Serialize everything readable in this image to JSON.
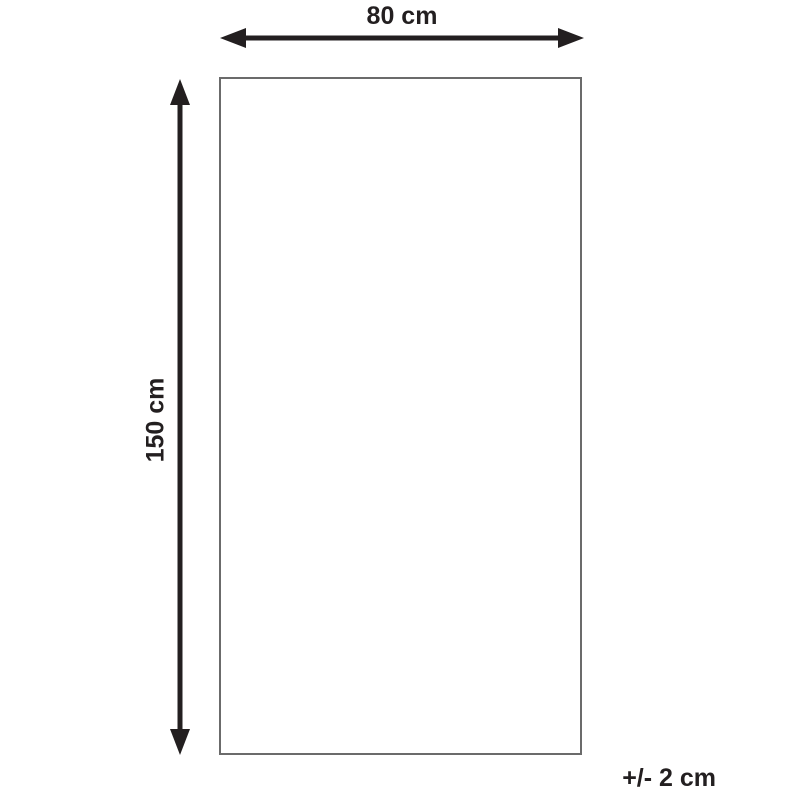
{
  "diagram": {
    "type": "product-dimension-diagram",
    "width_label": "80 cm",
    "height_label": "150 cm",
    "tolerance_label": "+/- 2 cm"
  },
  "colors": {
    "arrow": "#231f20",
    "text": "#231f20",
    "rectangle_border": "#6b6b6b",
    "background": "#ffffff"
  }
}
